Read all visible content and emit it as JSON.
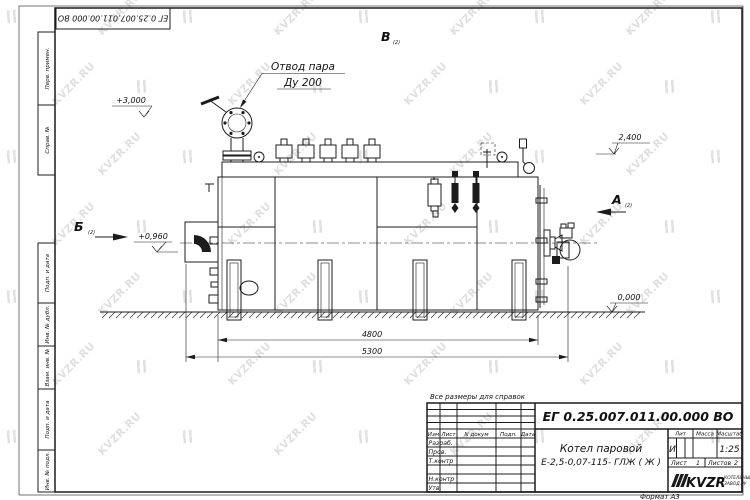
{
  "sheet": {
    "corner_stamp": "ЕГ 0.25.007.011.00.000  ВО",
    "note": "Все размеры для справок",
    "format_label": "Формат А3",
    "margin_labels": [
      "Перв. примен.",
      "Справ. №",
      "Подп. и дата",
      "Инв. № дубл.",
      "Взам. инв. №",
      "Подп. и дата",
      "Инв. № подл."
    ]
  },
  "watermark": {
    "text": "KVZR.RU",
    "color": "#c6c6c6"
  },
  "drawing": {
    "callout": {
      "line1": "Отвод пара",
      "line2": "Ду 200"
    },
    "view_labels": {
      "top": "В",
      "left": "Б",
      "right": "А",
      "sheet_ref": "(2)"
    },
    "elevation_marks": {
      "steam_top": "+3,000",
      "burner_axis": "+0,960",
      "drum_top": "2,400",
      "ground": "0,000"
    },
    "dimensions": {
      "support_span": "4800",
      "overall_length": "5300"
    }
  },
  "title_block": {
    "designation": "ЕГ 0.25.007.011.00.000  ВО",
    "product_line1": "Котел паровой",
    "product_line2": "Е-2,5-0,07-115- ГЛЖ ( Ж )",
    "columns": {
      "izm": "Изм",
      "list": "Лист",
      "doc": "N докум",
      "sign": "Подп.",
      "date": "Дата"
    },
    "roles": [
      "Разраб.",
      "Пров.",
      "Т.контр",
      "Н.контр",
      "Утв."
    ],
    "lit_header": "Лит",
    "mass_header": "Масса",
    "scale_header": "Масштаб",
    "lit_value": "И",
    "scale_value": "1:25",
    "sheet_word": "Лист",
    "sheet_num": "1",
    "sheets_word": "Листов",
    "sheets_num": "2",
    "logo": {
      "text": "KVZR",
      "tagline1": "КОТЕЛЬНЫЙ",
      "tagline2": "ЗАВОД.РУ"
    }
  }
}
